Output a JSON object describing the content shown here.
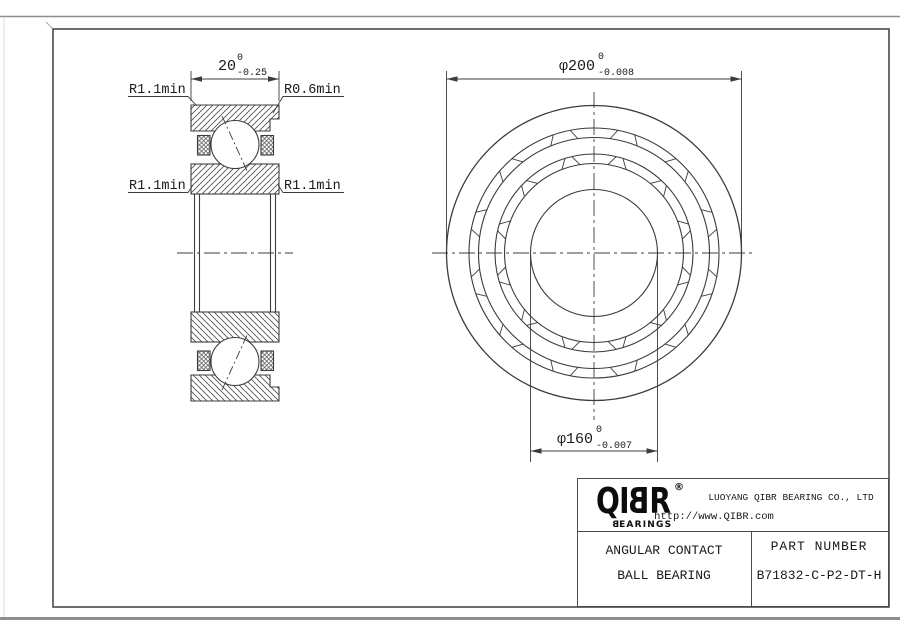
{
  "drawing": {
    "section_view": {
      "width_dim": {
        "value": "20",
        "upper_tol": "0",
        "lower_tol": "-0.25"
      },
      "fillet_top_left": "R1.1min",
      "fillet_top_right": "R0.6min",
      "fillet_mid_left": "R1.1min",
      "fillet_mid_right": "R1.1min"
    },
    "front_view": {
      "outer_dia_dim": {
        "value": "φ200",
        "upper_tol": "0",
        "lower_tol": "-0.008"
      },
      "bore_dia_dim": {
        "value": "φ160",
        "upper_tol": "0",
        "lower_tol": "-0.007"
      }
    }
  },
  "title_block": {
    "logo": {
      "part_qi": "QI",
      "part_b": "B",
      "part_r": "R",
      "registered": "®",
      "sub_b": "B",
      "sub_rest": "EARINGS"
    },
    "company": "LUOYANG QIBR BEARING CO., LTD",
    "website": "http://www.QIBR.com",
    "product_line1": "ANGULAR CONTACT",
    "product_line2": "BALL BEARING",
    "part_number_label": "PART NUMBER",
    "part_number": "B71832-C-P2-DT-H"
  },
  "colors": {
    "line": "#3c3c3c",
    "text": "#1a1a1a",
    "frame": "#4a4a4a",
    "outer_border": "#8e8e8e"
  }
}
